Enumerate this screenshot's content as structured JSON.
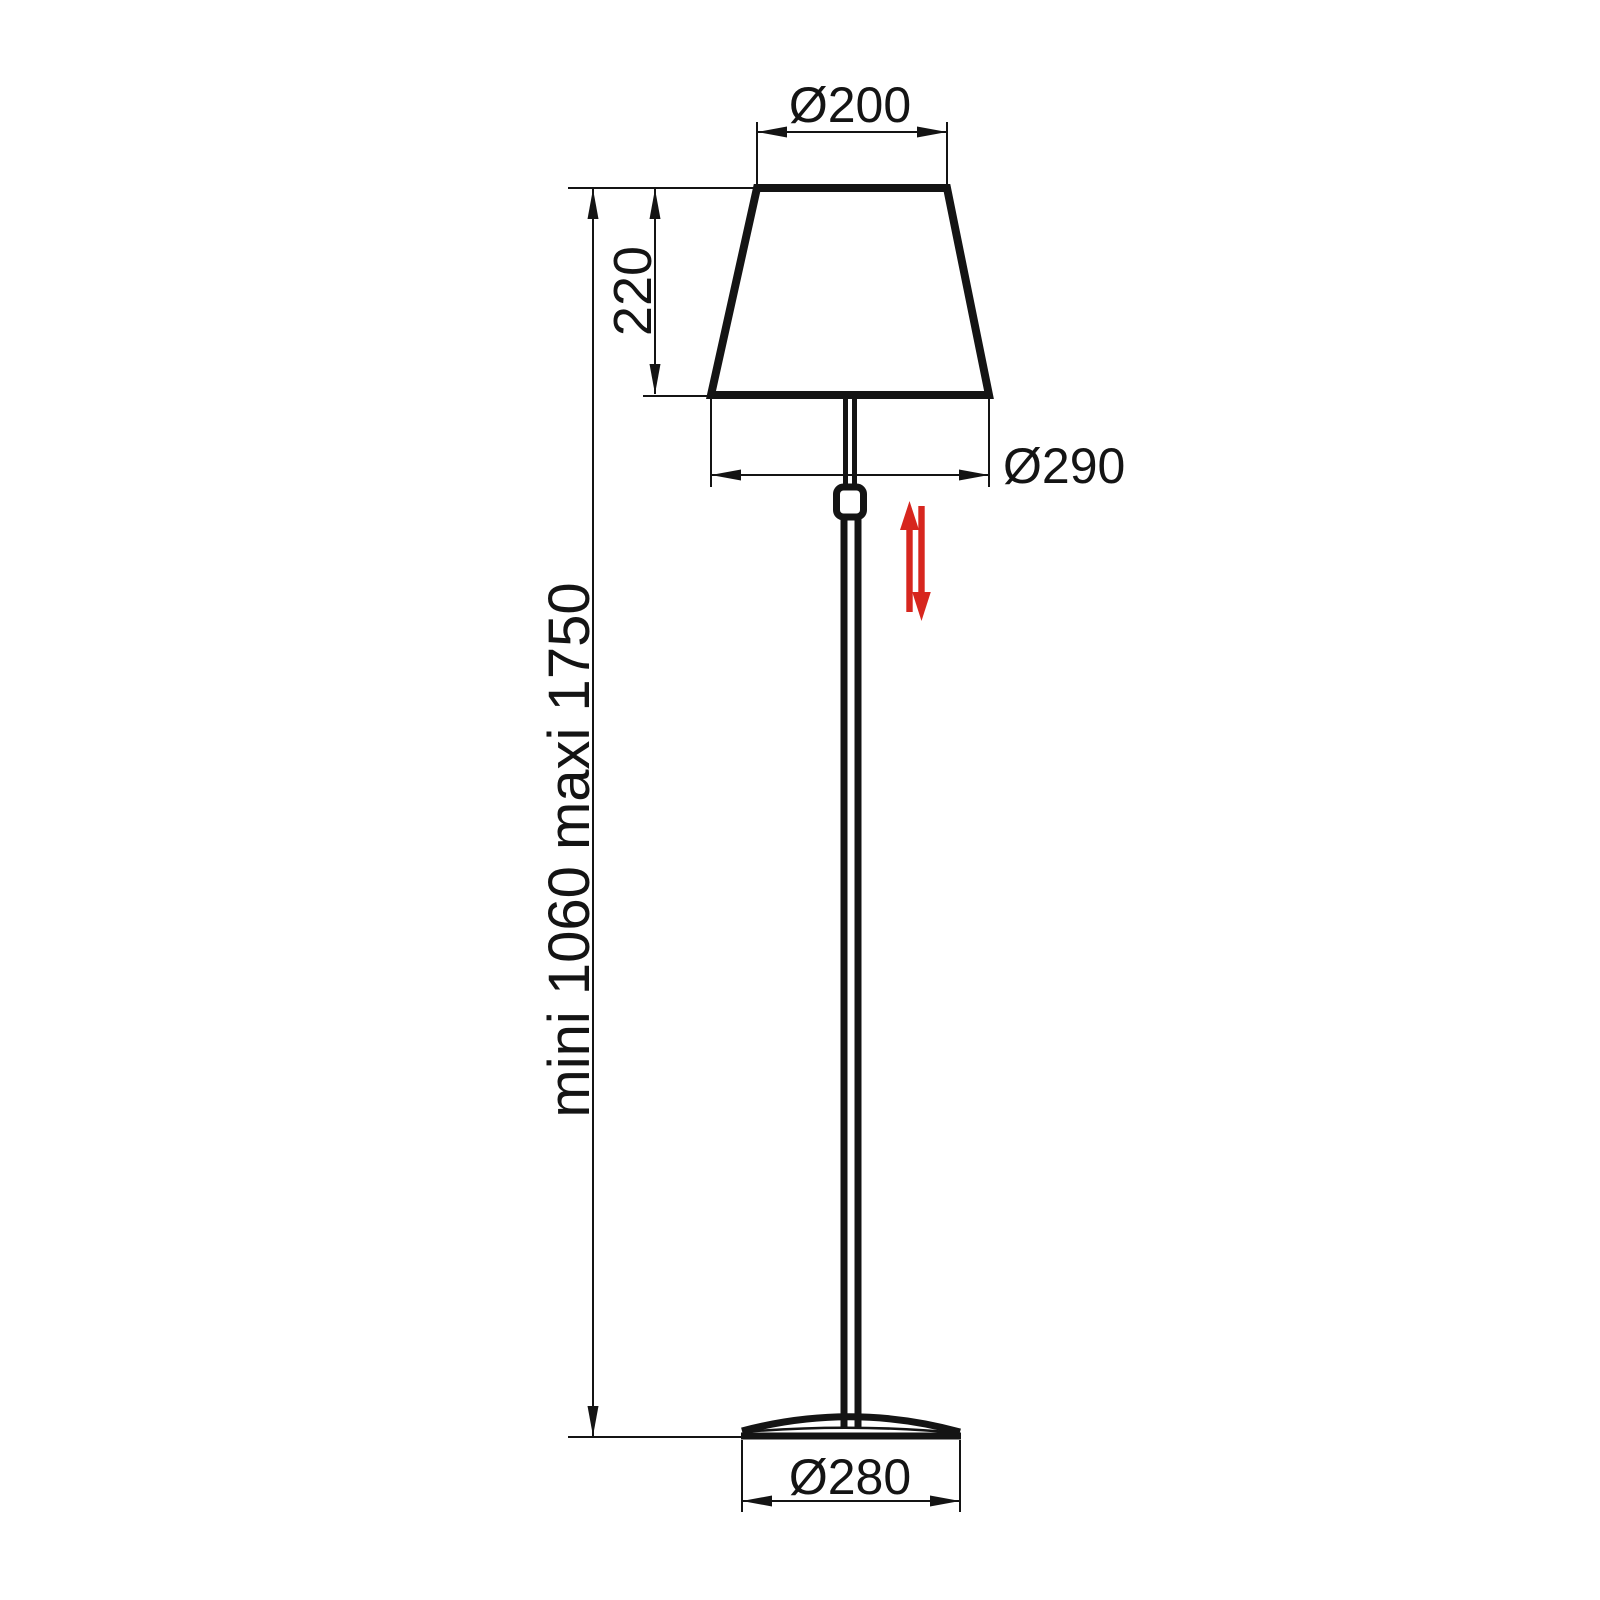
{
  "diagram": {
    "background_color": "#ffffff",
    "line_color": "#141414",
    "accent_color": "#d7261e",
    "labels": {
      "shade_top_diameter": "Ø200",
      "shade_height": "220",
      "shade_bottom_diameter": "Ø290",
      "overall_height": "mini 1060 maxi 1750",
      "base_diameter": "Ø280"
    }
  }
}
